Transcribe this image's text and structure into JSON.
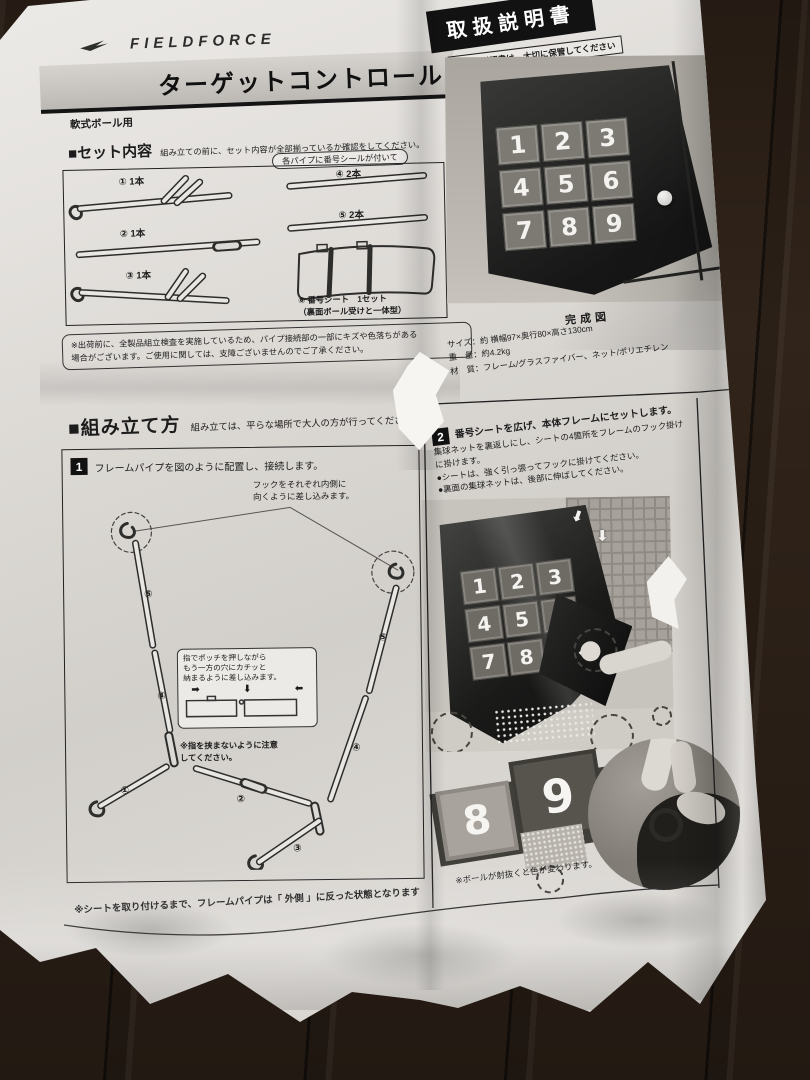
{
  "colors": {
    "floor": "#31241a",
    "paper": "#dcd9d5",
    "ink": "#1c1c1c",
    "manual_header_bg": "#121212"
  },
  "icons": {
    "arrow_right": "➡",
    "arrow_down": "⬇",
    "arrow_left": "⬅"
  },
  "header": {
    "brand": "FIELDFORCE",
    "title": "ターゲットコントロール",
    "subtitle": "軟式ボール用",
    "manual_title": "取扱説明書",
    "manual_note": "本取扱説明書は、大切に保管してください"
  },
  "set_contents": {
    "heading": "■セット内容",
    "lead": "組み立ての前に、セット内容が全部揃っているか確認をしてください。",
    "callout": "各パイプに番号シールが付いて",
    "items": [
      {
        "num": "①",
        "qty": "1本"
      },
      {
        "num": "②",
        "qty": "1本"
      },
      {
        "num": "③",
        "qty": "1本"
      },
      {
        "num": "④",
        "qty": "2本"
      },
      {
        "num": "⑤",
        "qty": "2本"
      }
    ],
    "sheet_item": {
      "num": "⑥",
      "label": "番号シート　1セット",
      "sub": "（裏面ボール受けと一体型）"
    },
    "note1": "※出荷前に、全製品組立検査を実施しているため、パイプ接続部の一部にキズや色落ちがある",
    "note2": "場合がございます。ご使用に関しては、支障ございませんのでご了承ください。"
  },
  "product": {
    "caption": "完成図",
    "spec_size": "サイズ：約 横幅97×奥行80×高さ130cm",
    "spec_weight": "重　量：約4.2kg",
    "spec_material": "材　質：フレーム/グラスファイバー、ネット/ポリエチレン",
    "numbers": [
      "1",
      "2",
      "3",
      "4",
      "5",
      "6",
      "7",
      "8",
      "9"
    ]
  },
  "assembly": {
    "heading": "■組み立て方",
    "lead": "組み立ては、平らな場所で大人の方が行ってください",
    "step1": {
      "num": "1",
      "text": "フレームパイプを図のように配置し、接続します。",
      "hook_note": "フックをそれぞれ内側に\n向くように差し込みます。",
      "inset_line1": "指でポッチを押しながら",
      "inset_line2": "もう一方の穴にカチッと",
      "inset_line3": "納まるように差し込みます。",
      "caution1": "※指を挟まないように注意",
      "caution2": "してください。",
      "labels": [
        "⑤",
        "④",
        "①",
        "②",
        "③",
        "④",
        "⑤"
      ]
    },
    "bottom_note": "※シートを取り付けるまで、フレームパイプは「 外側 」に反った状態となります",
    "step2": {
      "num": "2",
      "line1": "番号シートを広げ、本体フレームにセットします。",
      "line2": "集球ネットを裏返しにし、シートの4箇所をフレームのフック掛け",
      "line3": "に掛けます。",
      "bullet1": "●シートは、強く引っ張ってフックに掛けてください。",
      "bullet2": "●裏面の集球ネットは、後部に伸ばしてください。",
      "photo_numbers": [
        "1",
        "2",
        "3",
        "4",
        "5",
        "6",
        "7",
        "8"
      ],
      "close_numbers": [
        "8",
        "9"
      ],
      "note": "※ボールが射抜くと色が変わります。"
    }
  }
}
